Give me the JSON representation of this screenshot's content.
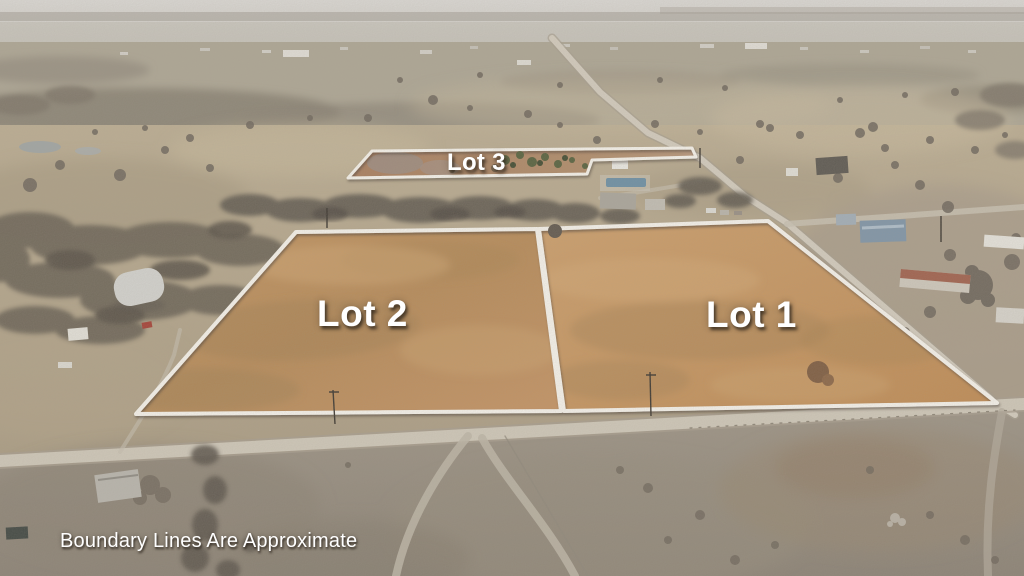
{
  "photo": {
    "type": "aerial-drone-photo",
    "scene": "Winter aerial view of rural acreage with three surveyed lots outlined in white over golden pasture, county roads, farm buildings, bare trees and a hazy horizon",
    "disclaimer": "Boundary Lines Are Approximate"
  },
  "lots": [
    {
      "name": "Lot 1",
      "points": "539,229 768,221 997,403 564,411"
    },
    {
      "name": "Lot 2",
      "points": "296,232 537,229 561,411 136,414"
    },
    {
      "name": "Lot 3",
      "points": "348,178 372,151 692,148 696,157 592,160 587,174"
    }
  ],
  "colors": {
    "boundary_white": "#f8f5ee",
    "lot_field_gold": "#c8965e",
    "lot3_ground_rust": "#a87a5a",
    "pasture_tan": "#b5a78c",
    "foreground_gray": "#968c7e",
    "sky_haze": "#d8d6d1",
    "tree_scrub": "#665f55",
    "road_gray": "#d0c9ba",
    "pond_gray_blue": "#9fa5a6"
  }
}
